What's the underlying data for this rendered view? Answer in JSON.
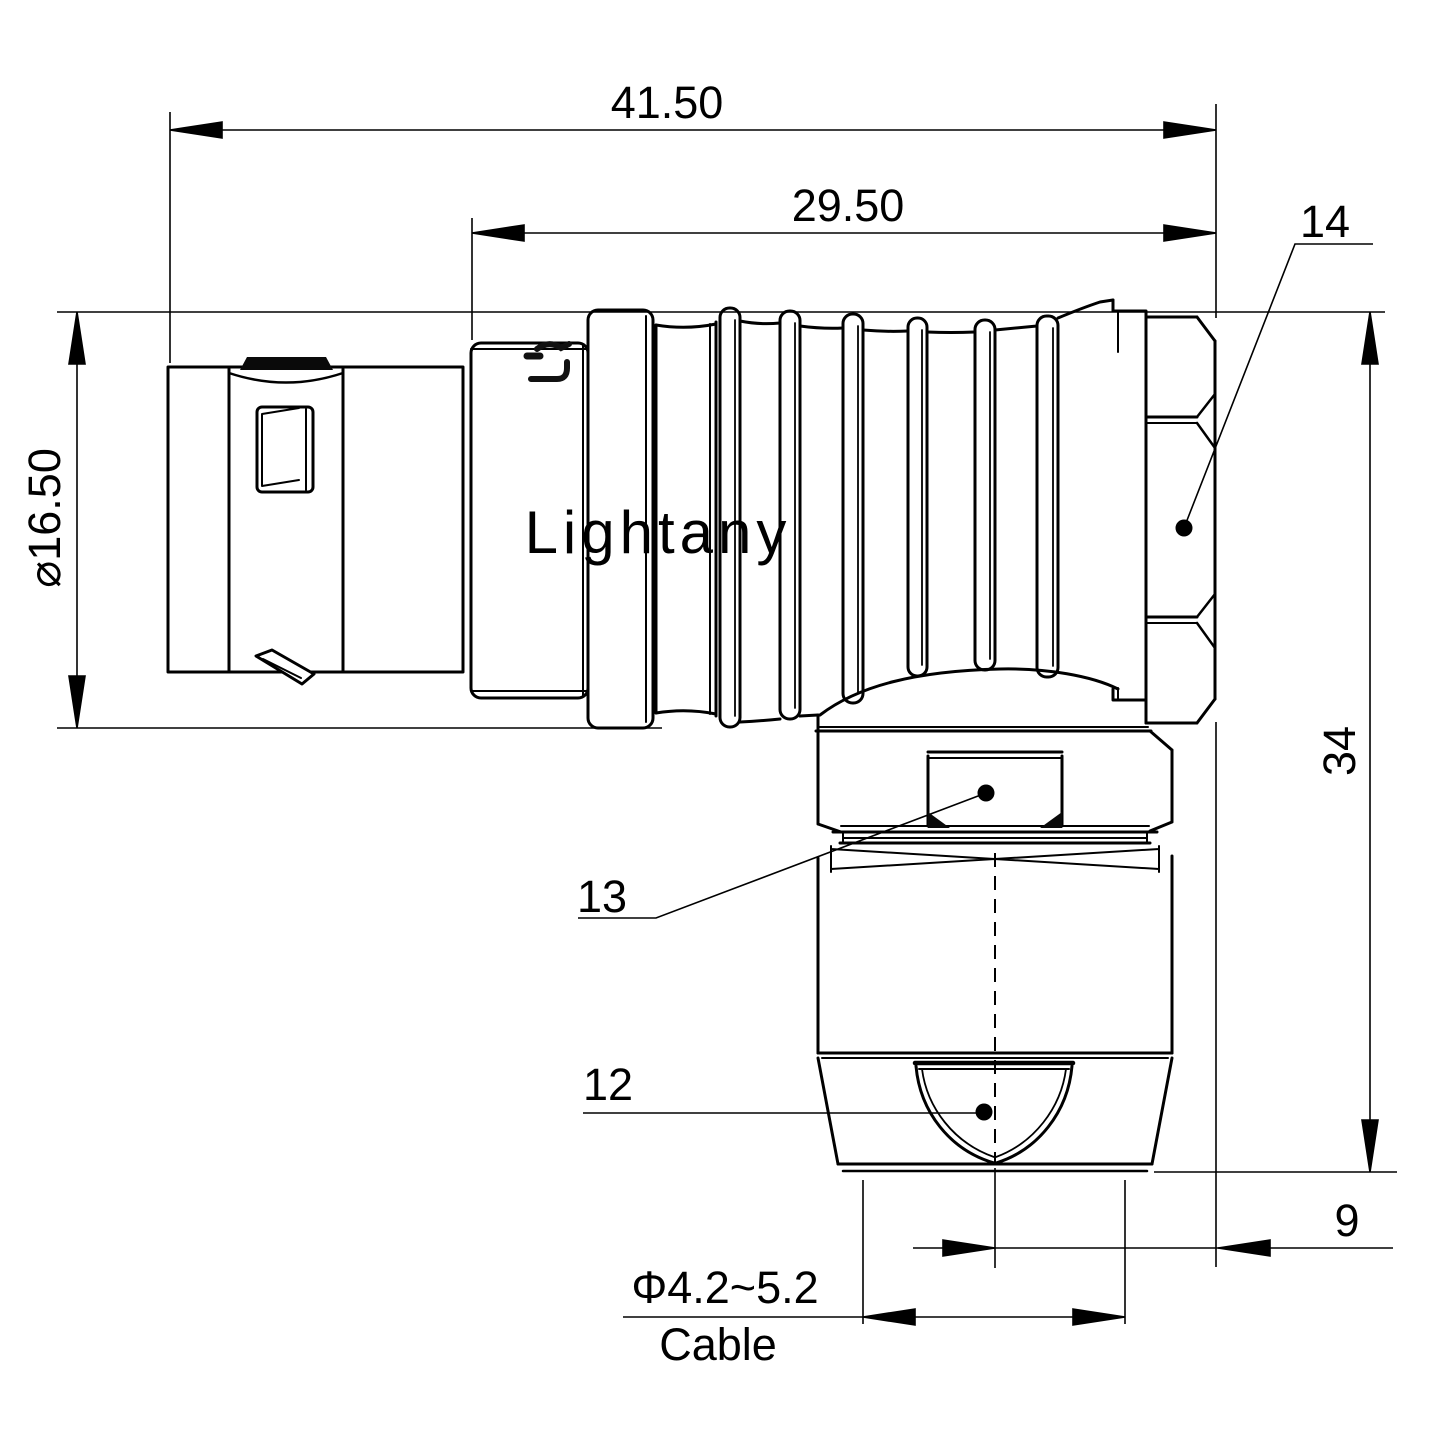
{
  "drawing": {
    "watermark": "Lightany",
    "engraving": "Lig",
    "dims": {
      "overall_length": "41.50",
      "body_length": "29.50",
      "front_diameter": "⌀16.50",
      "height": "34",
      "bend_offset": "9",
      "cable_diameter": "Φ4.2~5.2",
      "cable_word": "Cable"
    },
    "labels": {
      "backnut": "14",
      "clamp_nut": "13",
      "cable_bushing": "12"
    },
    "colors": {
      "line": "#000000",
      "watermark": "#f3d2d2",
      "background": "#ffffff"
    }
  }
}
